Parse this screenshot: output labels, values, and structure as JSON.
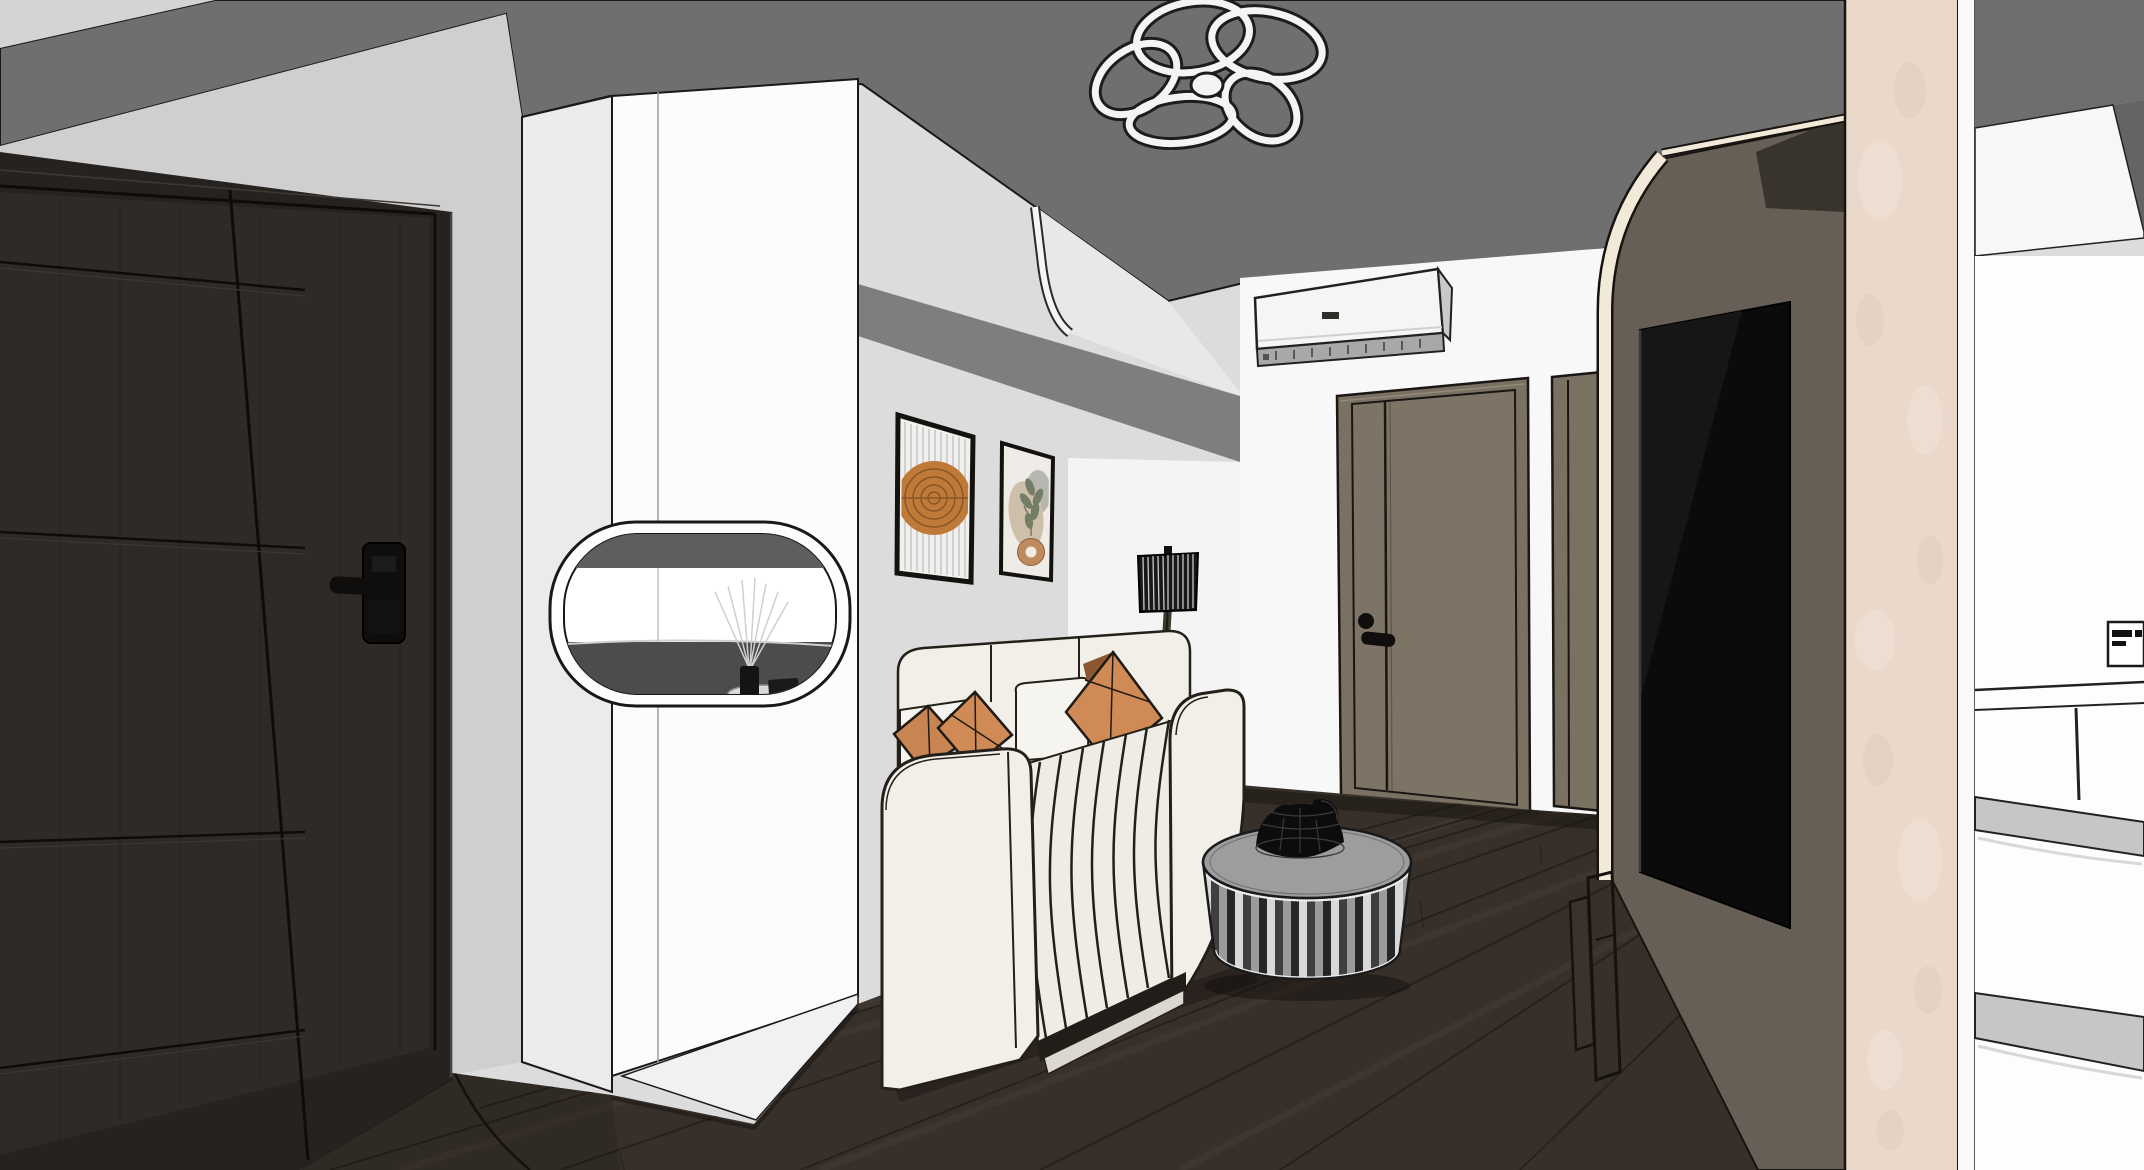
{
  "scene": {
    "type": "3d-interior-render",
    "view": "apartment entry and living room with sofa, TV wall, interior doors and kitchen glimpse",
    "render_style": "sketchup-line-render"
  },
  "objects": [
    {
      "name": "ceiling-pendant-light",
      "label": "flower shaped ring ceiling lamp"
    },
    {
      "name": "entry-door",
      "label": "dark wood entry door"
    },
    {
      "name": "smart-door-lock",
      "label": "black smart lock with lever handle"
    },
    {
      "name": "shoe-cabinet",
      "label": "white tall cabinet with rounded display niche"
    },
    {
      "name": "reed-diffuser",
      "label": "reed diffuser on niche shelf"
    },
    {
      "name": "wall-art-left",
      "label": "abstract line art with orange sun"
    },
    {
      "name": "wall-art-right",
      "label": "botanical abstract art"
    },
    {
      "name": "air-conditioner",
      "label": "wall mounted split AC unit"
    },
    {
      "name": "floor-lamp",
      "label": "black pleated shade floor lamp"
    },
    {
      "name": "sofa",
      "label": "cream channel-tufted sofa"
    },
    {
      "name": "throw-pillows",
      "label": "terracotta throw pillows"
    },
    {
      "name": "coffee-table",
      "label": "fluted drum coffee table"
    },
    {
      "name": "fruit-basket",
      "label": "black wire basket"
    },
    {
      "name": "interior-door-1",
      "label": "wood interior door"
    },
    {
      "name": "interior-door-2",
      "label": "wood interior door partially visible"
    },
    {
      "name": "tv",
      "label": "wall mounted television"
    },
    {
      "name": "media-wall",
      "label": "taupe TV feature wall with curved cream trim"
    },
    {
      "name": "tv-console",
      "label": "low media console outline"
    },
    {
      "name": "stone-pillar",
      "label": "travertine pillar"
    },
    {
      "name": "kitchen-upper-cabinets",
      "label": "white upper cabinets"
    },
    {
      "name": "refrigerator",
      "label": "white multi-drawer refrigerator with illegible brand label"
    },
    {
      "name": "wood-floor",
      "label": "dark wood plank floor with door swing arc"
    }
  ],
  "colors": {
    "base-wall": "#dcdcdc",
    "corner-wedge": "#d4d4d4",
    "ceiling": "#6f6f6f",
    "entry-wall": "#cfcfcf",
    "door-block": "#262220",
    "door-leaf": "#2e2a26",
    "door-line": "#0e0c0a",
    "door-hilite": "#4a443e",
    "lock-black": "#0f0e0d",
    "cabinet-front": "#fcfcfc",
    "cabinet-side": "#ebebeb",
    "cabinet-plinth": "#f1f1f1",
    "outline": "#1b1917",
    "niche-top": "#5e5e5e",
    "niche-bottom": "#4c4c4c",
    "tray-gray": "#d9d9d9",
    "soffit-band": "#7e7e7e",
    "bulkhead-face": "#e8e8e8",
    "trim-white": "#f5f5f5",
    "far-wall": "#f8f8f8",
    "art-frame": "#14120f",
    "art1-bg": "#f1f0ee",
    "art1-line": "#b5b5b5",
    "art1-circle": "#bf7a39",
    "art1-ring": "#8a5526",
    "art2-bg": "#efece7",
    "art2-gray": "#b7b7b2",
    "art2-blob": "#cdbfa9",
    "art2-leaf": "#747d66",
    "art2-donut": "#bf8a5e",
    "ac-body": "#f5f5f5",
    "ac-cap": "#c9c9c9",
    "ac-vent": "#a8a8a8",
    "ac-logo": "#2f2d2a",
    "wood-door": "#7a7163",
    "wood-door-line": "#191613",
    "wood-door-hilite": "#938a7a",
    "lamp-shade": "#181818",
    "lamp-stripe": "#e8e8e8",
    "lamp-stem": "#3f3a2e",
    "sofa-cream": "#f2efe9",
    "sofa-seat": "#efece5",
    "sofa-line": "#232019",
    "sofa-base": "#211d18",
    "sofa-plinth": "#ddd8cf",
    "pillow-orange": "#cf8a55",
    "pillow-orange2": "#c98551",
    "pillow-shadow": "#8a5731",
    "pillow-white": "#f6f4ef",
    "floor": "#37302a",
    "floor-line": "#241f19",
    "floor-streak": "#4e4338",
    "shadow": "#120e0a",
    "table-top": "#9d9d9d",
    "table-rim": "#ececec",
    "stripe-a": "#d8d8d8",
    "stripe-b": "#3f3f3f",
    "stripe-c": "#9b9b9b",
    "stripe-d": "#262626",
    "basket-black": "#0c0c0c",
    "basket-mesh": "#3a3a3a",
    "media-panel": "#675f56",
    "media-trim": "#f2e9d8",
    "media-wedge": "#38332d",
    "tv-black": "#0b0b0b",
    "tv-sheen": "#161616",
    "pillar": "#ead8cb",
    "pillar-blotch-light": "#f4e6da",
    "pillar-blotch-dark": "#dfcaba",
    "kitchen-gray": "#6e6e6e",
    "kitchen-gray2": "#646464",
    "fridge-white": "#fdfdfd",
    "fridge-line": "#24221f",
    "fridge-handle": "#c6c6c6",
    "label-dark": "#141210",
    "flower-dark": "#1c1c1c",
    "flower-white": "#f4f4f4"
  }
}
